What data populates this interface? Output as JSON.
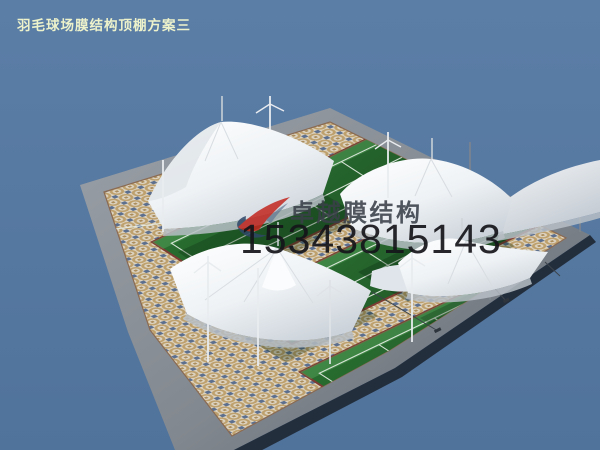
{
  "page": {
    "title": "羽毛球场膜结构顶棚方案三"
  },
  "watermark": {
    "brand": "卓越膜结构",
    "phone": "15343815143",
    "logo_icon": "swoosh-ribbon-icon"
  },
  "scene": {
    "subject": "3D render of badminton courts covered by white tensile membrane canopies on a mosaic-paved plaza",
    "canopy_count": 6,
    "court_strip_count": 3
  },
  "colors": {
    "sky": "#54779E",
    "membrane_white": "#F7F9FB",
    "membrane_shade": "#C9D0D7",
    "court_green": "#2B6E31",
    "court_line": "#E8EFE7",
    "court_border_red": "#7D3C33",
    "pavement_base": "#DCD3C1",
    "pavement_ring_tan": "#BDA06C",
    "pavement_accent_blue": "#5C6F8E",
    "road_gray": "#8A9098",
    "platform_edge_dark": "#232E3D",
    "logo_red": "#C3271F",
    "logo_blue": "#2E4668",
    "title_text": "#EDF2CB",
    "phone_text": "#15151A"
  }
}
